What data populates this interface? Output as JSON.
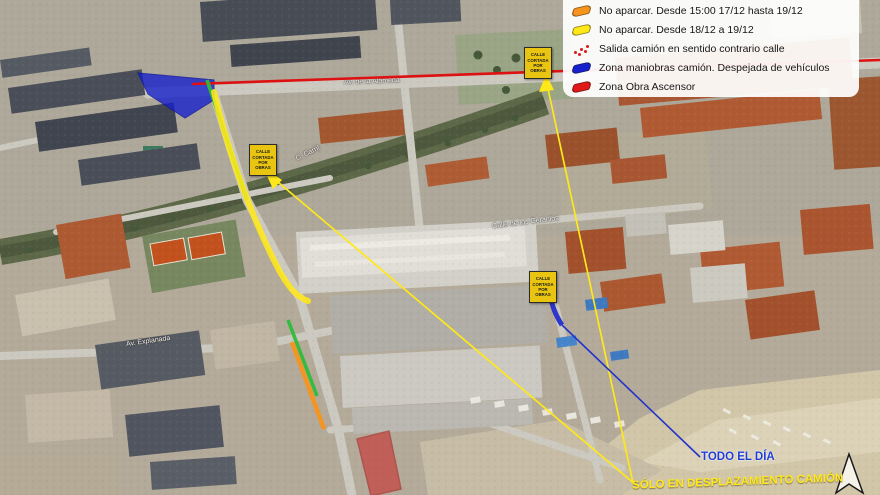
{
  "legend": {
    "items": [
      {
        "label": "No aparcar. Desde 15:00 17/12 hasta 19/12",
        "color": "#f7941d",
        "swatch": "zone"
      },
      {
        "label": "No aparcar. Desde 18/12 a 19/12",
        "color": "#ffe81a",
        "swatch": "zone"
      },
      {
        "label": "Salida camión en sentido contrario calle",
        "color": "#e01818",
        "swatch": "dotted-arrow"
      },
      {
        "label": "Zona maniobras camión. Despejada de vehículos",
        "color": "#1822cc",
        "swatch": "zone"
      },
      {
        "label": "Zona Obra Ascensor",
        "color": "#e01818",
        "swatch": "zone"
      }
    ]
  },
  "map": {
    "sign_label": "CALLE CORTADA POR OBRAS",
    "callouts": {
      "todo_el_dia": "TODO EL DÍA",
      "solo_en_desplazamiento": "SÓLO EN DESPLAZAMIENTO CAMIÓN"
    },
    "street_labels": {
      "avenue": "Av. de la Alameda",
      "carril": "C. Carril",
      "geranios": "Calle de los Geranios",
      "explanada": "Av. Explanada"
    }
  },
  "colors": {
    "no_parking_orange": "#f7941d",
    "no_parking_yellow": "#ffe81a",
    "exit_route_red": "#dd1111",
    "maneuver_blue": "#1822cc",
    "work_zone_red": "#e01818",
    "route_green": "#2fbc3c"
  }
}
